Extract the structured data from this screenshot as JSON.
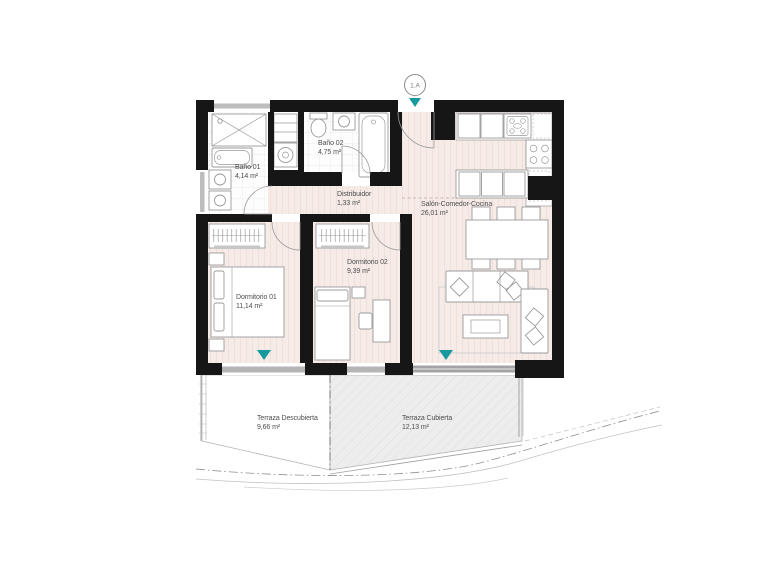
{
  "plan": {
    "entrance": {
      "label": "1.A"
    },
    "rooms": [
      {
        "name": "Baño 01",
        "area": "4,14 m²"
      },
      {
        "name": "Baño 02",
        "area": "4,75 m²"
      },
      {
        "name": "Distribuidor",
        "area": "1,33 m²"
      },
      {
        "name": "Salón-Comedor-Cocina",
        "area": "26,01 m²"
      },
      {
        "name": "Dormitorio 01",
        "area": "11,14 m²"
      },
      {
        "name": "Dormitorio 02",
        "area": "9,39 m²"
      },
      {
        "name": "Terraza Descubierta",
        "area": "9,66 m²"
      },
      {
        "name": "Terraza Cubierta",
        "area": "12,13 m²"
      }
    ],
    "colors": {
      "wall": "#161616",
      "floor": "#f6ebe7",
      "floor_stripe": "#ecdfd9",
      "bath_tile": "#fdfdfd",
      "terrace_covered": "#ededed",
      "window_band": "#b5b5b5",
      "window_marker_accent": "#18989f",
      "furniture_line": "#9b9b9b",
      "label_text": "#4f4f4f"
    }
  }
}
